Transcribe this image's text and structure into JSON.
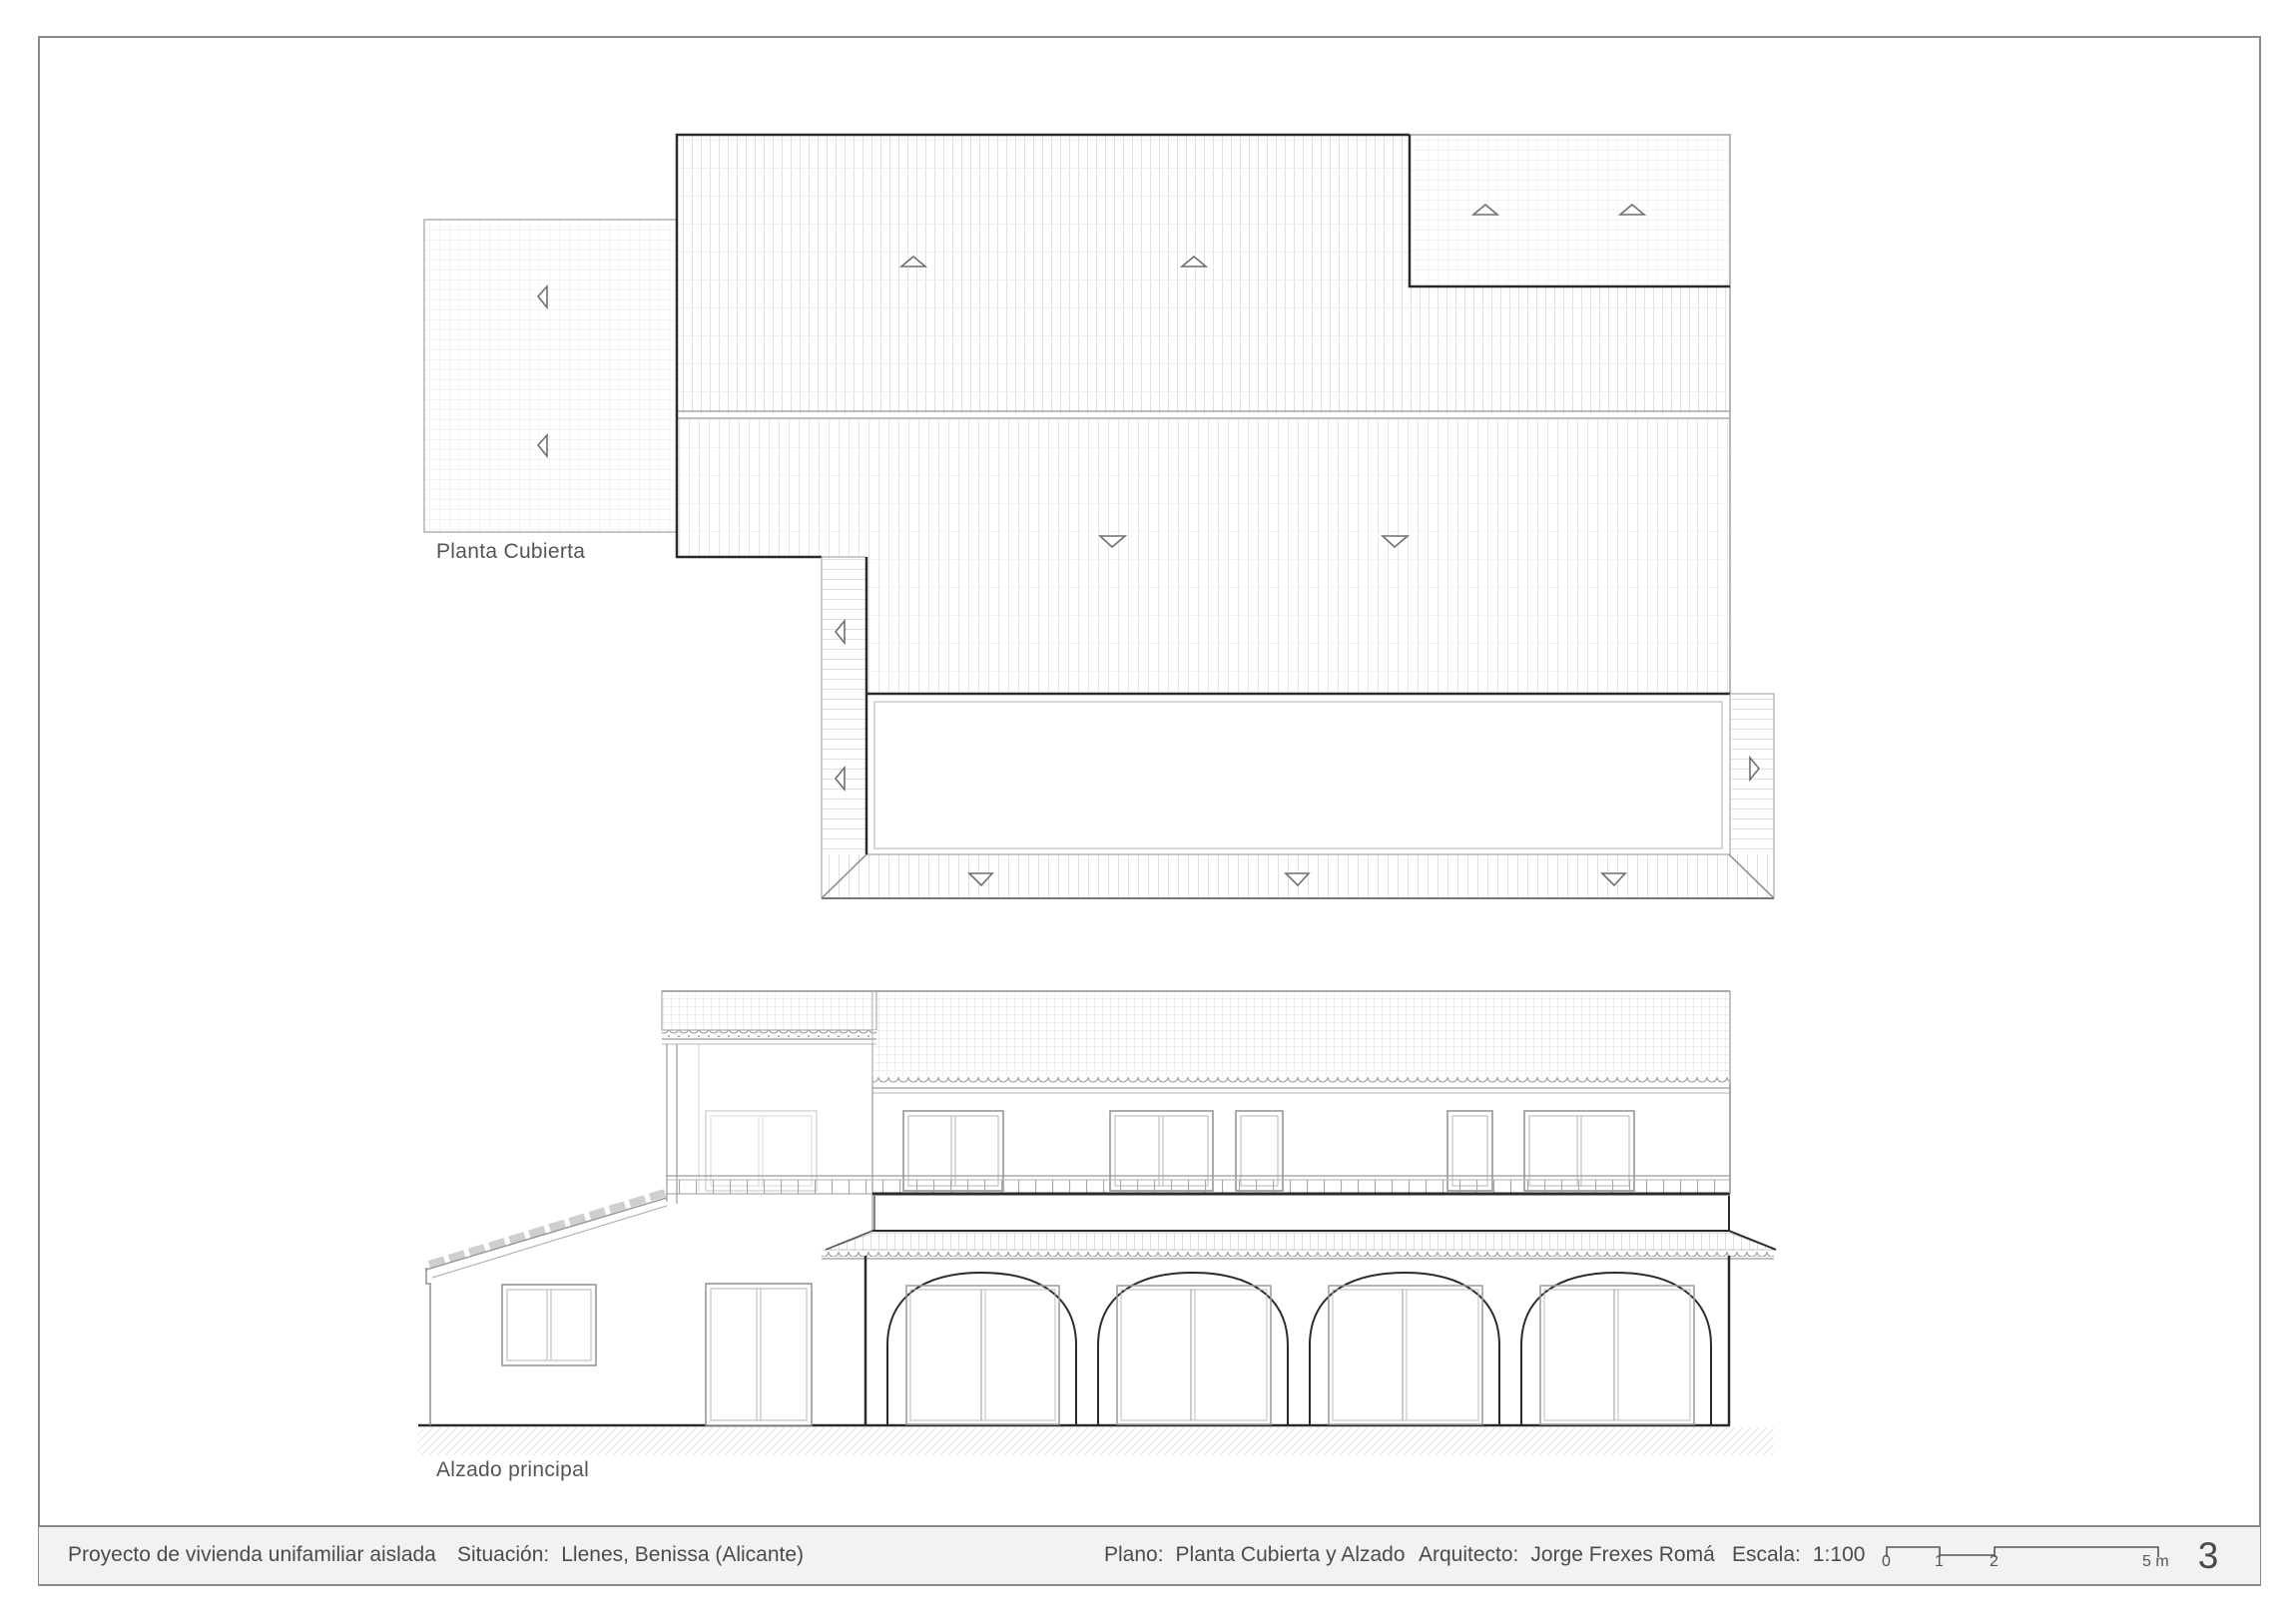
{
  "drawing": {
    "plan_label": "Planta Cubierta",
    "elevation_label": "Alzado principal"
  },
  "title_block": {
    "project": "Proyecto de vivienda unifamiliar aislada",
    "location_label": "Situación:",
    "location_value": "Llenes, Benissa (Alicante)",
    "plan_label": "Plano:",
    "plan_value": "Planta Cubierta y Alzado",
    "architect_label": "Arquitecto:",
    "architect_value": "Jorge Frexes Romá",
    "scale_label": "Escala:",
    "scale_value": "1:100",
    "sheet_number": "3",
    "scale_bar": {
      "tick_labels": [
        "0",
        "1",
        "2",
        "5 m"
      ]
    }
  },
  "colors": {
    "paper": "#ffffff",
    "titlebar_bg": "#f2f2f1",
    "border_gray": "#8a8a8a",
    "line_dark": "#2b2b2b",
    "line_gray": "#9a9a9a",
    "hatch_light": "#e6e6e6",
    "text_gray": "#4b4b4b"
  }
}
